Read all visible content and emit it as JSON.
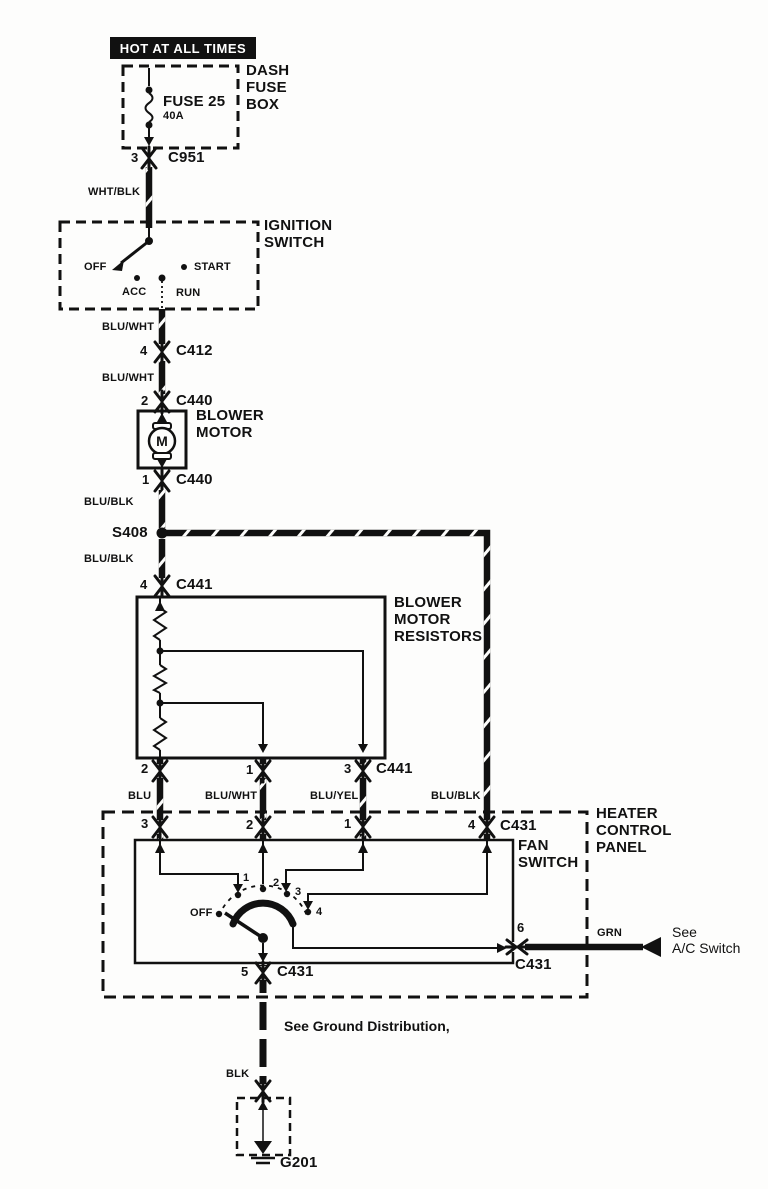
{
  "banner": {
    "text": "HOT AT ALL TIMES"
  },
  "dash_fuse_box": {
    "label": "DASH\nFUSE\nBOX",
    "fuse_name": "FUSE 25",
    "fuse_rating": "40A"
  },
  "connectors": {
    "c951": {
      "pin": "3",
      "name": "C951"
    },
    "c412": {
      "pin": "4",
      "name": "C412"
    },
    "c440_top": {
      "pin": "2",
      "name": "C440"
    },
    "c440_bottom": {
      "pin": "1",
      "name": "C440"
    },
    "c441_main": {
      "pin": "4",
      "name": "C441"
    },
    "c441_row": {
      "pins": [
        "2",
        "1",
        "3"
      ],
      "name": "C441"
    },
    "c431_row": {
      "pins": [
        "3",
        "2",
        "1",
        "4"
      ],
      "name": "C431"
    },
    "c431_pin5": {
      "pin": "5",
      "name": "C431"
    },
    "c431_pin6": {
      "pin": "6",
      "name": "C431"
    },
    "g201": {
      "name": "G201"
    }
  },
  "splice": {
    "name": "S408"
  },
  "wires": {
    "wht_blk": "WHT/BLK",
    "blu_wht_1": "BLU/WHT",
    "blu_wht_2": "BLU/WHT",
    "blu_blk_1": "BLU/BLK",
    "blu_blk_2": "BLU/BLK",
    "blu": "BLU",
    "blu_wht_3": "BLU/WHT",
    "blu_yel": "BLU/YEL",
    "blu_blk_3": "BLU/BLK",
    "grn": "GRN",
    "blk": "BLK"
  },
  "ignition_switch": {
    "label": "IGNITION\nSWITCH",
    "positions": {
      "off": "OFF",
      "acc": "ACC",
      "run": "RUN",
      "start": "START"
    }
  },
  "blower_motor": {
    "label": "BLOWER\nMOTOR",
    "symbol": "M"
  },
  "blower_resistors": {
    "label": "BLOWER\nMOTOR\nRESISTORS"
  },
  "heater_panel": {
    "label": "HEATER\nCONTROL\nPANEL"
  },
  "fan_switch": {
    "label": "FAN\nSWITCH",
    "positions": {
      "off": "OFF",
      "p1": "1",
      "p2": "2",
      "p3": "3",
      "p4": "4"
    }
  },
  "notes": {
    "ac_switch": "See\nA/C Switch",
    "ground": "See Ground Distribution,"
  },
  "colors": {
    "wire": "#111111",
    "paper": "#fdfdfc",
    "banner_bg": "#111111",
    "banner_text": "#ffffff"
  }
}
